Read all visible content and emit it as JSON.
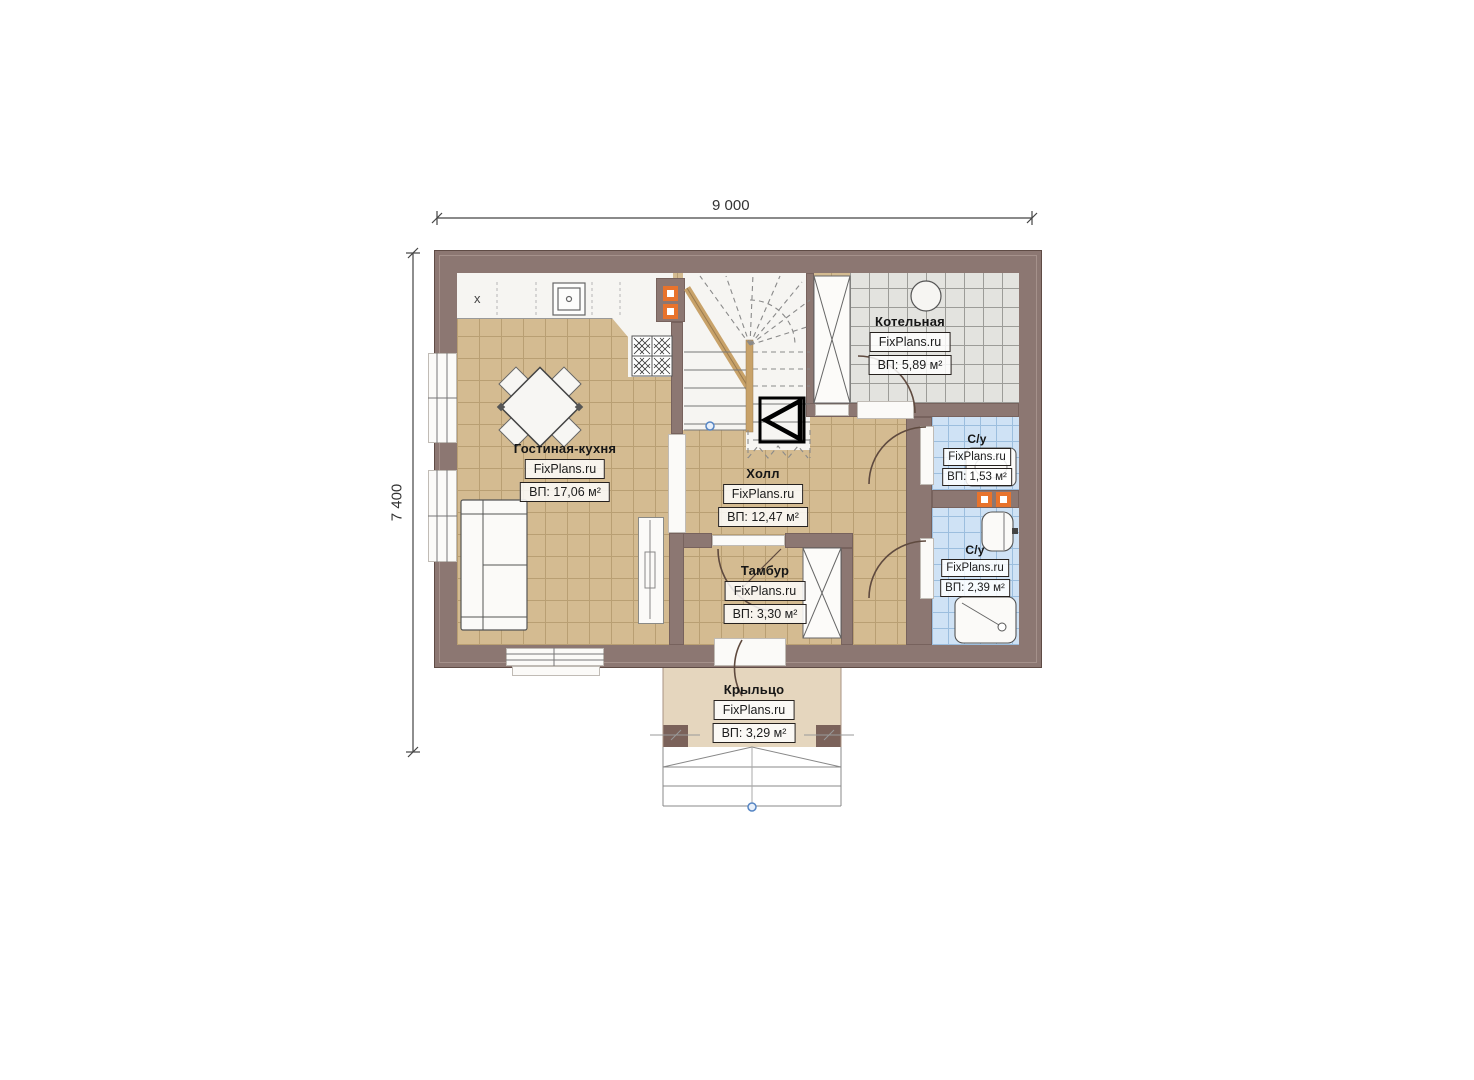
{
  "watermark": "FixPlans.ru",
  "dimensions": {
    "top": "9 000",
    "left": "7 400"
  },
  "kitchen_x_marker": "x",
  "rooms": [
    {
      "name": "Гостиная-кухня",
      "area": "ВП: 17,06 м²"
    },
    {
      "name": "Холл",
      "area": "ВП: 12,47 м²"
    },
    {
      "name": "Котельная",
      "area": "ВП: 5,89 м²"
    },
    {
      "name": "С/у",
      "area": "ВП: 1,53 м²"
    },
    {
      "name": "С/у",
      "area": "ВП: 2,39 м²"
    },
    {
      "name": "Тамбур",
      "area": "ВП: 3,30 м²"
    },
    {
      "name": "Крыльцо",
      "area": "ВП: 3,29 м²"
    }
  ],
  "colors": {
    "wall": "#8c7772",
    "floor_beige": "#d4bb91",
    "floor_gray": "#e3e3df",
    "floor_blue": "#cfe2f5",
    "porch": "#e5d6be",
    "vent_orange": "#e8732c",
    "stair_white": "#f6f5f2"
  }
}
